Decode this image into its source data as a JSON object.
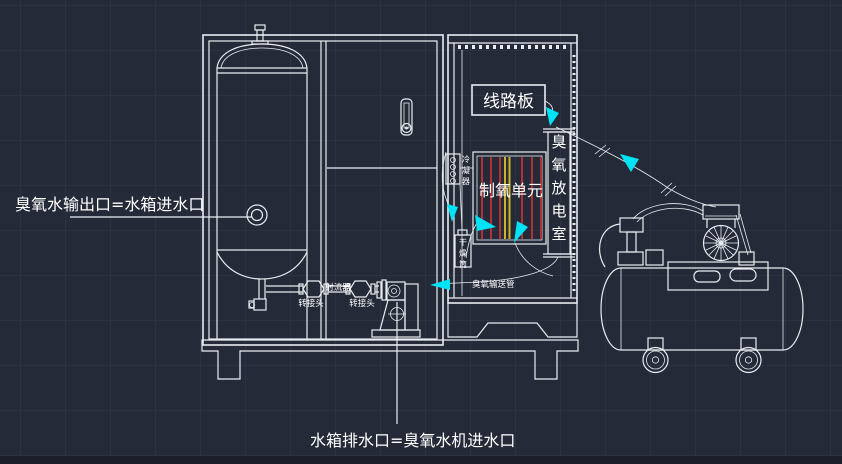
{
  "colors": {
    "bg": "#242a37",
    "grid": "#2b3243",
    "line": "#e9edf1",
    "cyan": "#00e2f5",
    "red": "#b03236",
    "yellow": "#cdb32a"
  },
  "drawing": {
    "label_left_outlet": "臭氧水输出口=水箱进水口",
    "label_bottom_drain": "水箱排水口=臭氧水机进水口",
    "circuit_board": "线路板",
    "oxygen_unit": "制氧单元",
    "ozone_chamber_chars": [
      "臭",
      "氧",
      "放",
      "电",
      "室"
    ],
    "condenser": "冷凝器",
    "dryer": "干燥筒",
    "ozone_tube": "臭氧输送管",
    "injector": "射流器",
    "adapter_left": "转接头",
    "adapter_right": "转接头"
  }
}
